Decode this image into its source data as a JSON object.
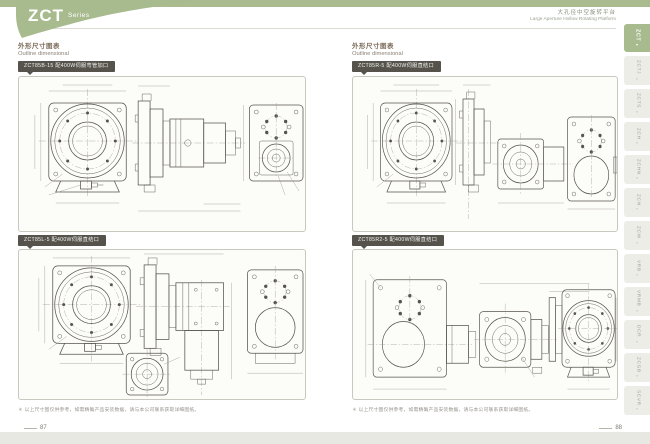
{
  "header": {
    "series": "ZCT",
    "series_suffix": "Series",
    "product_zh": "大孔径中空旋转平台",
    "product_en": "Large Aperture Hollow Rotating Platform"
  },
  "pages": {
    "left": {
      "section_title_zh": "外形尺寸图表",
      "section_title_en": "Outline dimensional",
      "panels": [
        {
          "label": "ZCT85B-15 配400W伺服弯管加口"
        },
        {
          "label": "ZCT85L-5 配400W伺服直结口"
        }
      ],
      "footnote": "＊ 以上尺寸图仅供参考，如需精确产品安装数据，请与本公司联系获取详细图纸。",
      "page_number": "87"
    },
    "right": {
      "section_title_zh": "外形尺寸图表",
      "section_title_en": "Outline dimensional",
      "panels": [
        {
          "label": "ZCT85R-5 配400W伺服直结口"
        },
        {
          "label": "ZCT85R2-5 配400W伺服直结口"
        }
      ],
      "footnote": "＊ 以上尺寸图仅供参考，如需精确产品安装数据，请与本公司联系获取详细图纸。",
      "page_number": "88"
    }
  },
  "sidebar": {
    "active_tab": "ZCT",
    "caret": "»",
    "active_caret": "▾",
    "tabs": [
      "ZCTJ",
      "ZCTS",
      "ZCH",
      "ZCHN",
      "ZCN",
      "ZCW",
      "VRB",
      "VRMB",
      "DCR",
      "ZCGB",
      "SCVR"
    ]
  },
  "colors": {
    "accent_green": "#a8bb8e",
    "chip_dark": "#55534c",
    "panel_border": "#c9c8bf",
    "drawing_line": "#56544c"
  }
}
